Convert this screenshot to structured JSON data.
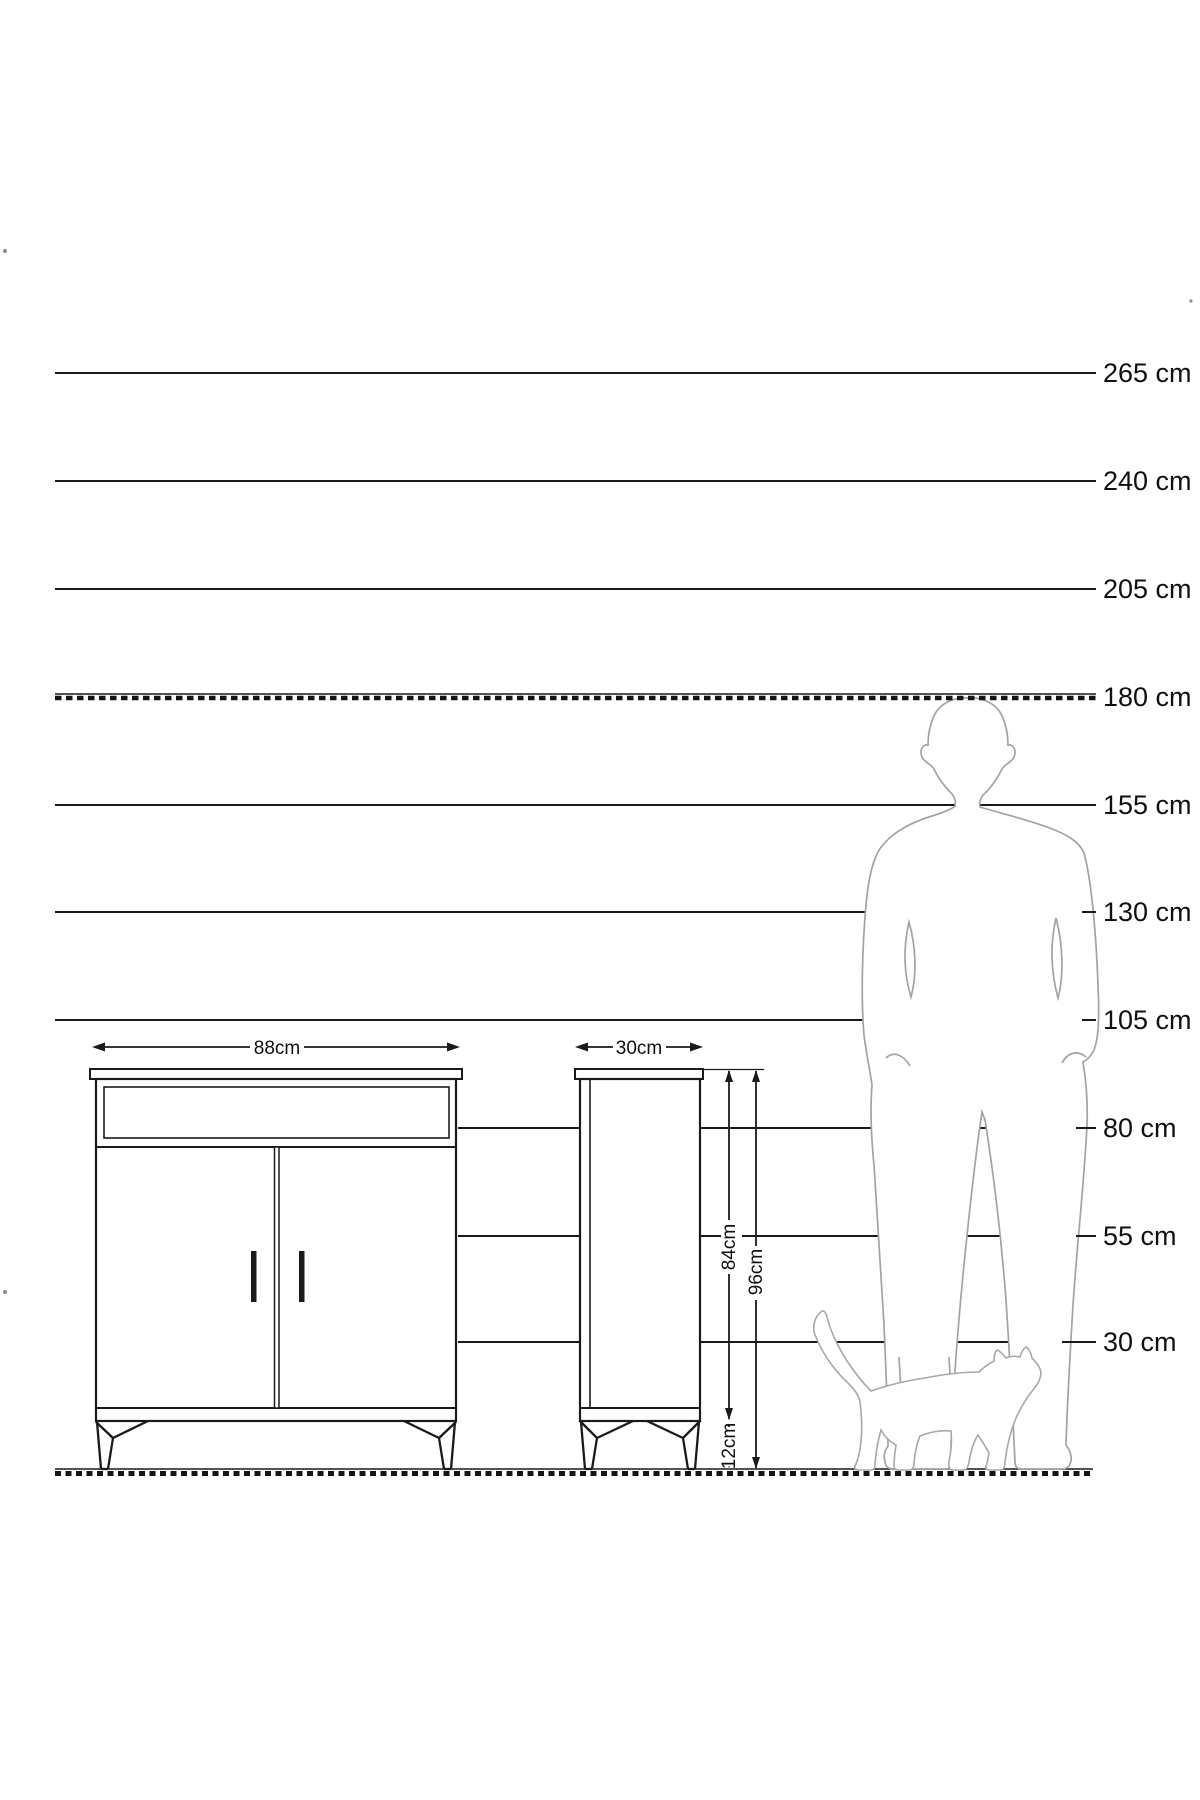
{
  "ruler": {
    "unit": "cm",
    "labels": [
      "265 cm",
      "240 cm",
      "205 cm",
      "180 cm",
      "155 cm",
      "130 cm",
      "105 cm",
      "80 cm",
      "55 cm",
      "30 cm"
    ]
  },
  "front_view": {
    "width_label": "88cm"
  },
  "side_view": {
    "width_label": "30cm",
    "body_height_label": "84cm",
    "total_height_label": "96cm",
    "leg_height_label": "12cm"
  },
  "figures": {
    "man": "man-silhouette",
    "cat": "cat-silhouette"
  },
  "colors": {
    "background": "#ffffff",
    "line": "#1a1a1a",
    "figure_outline": "#a3a3a3",
    "text": "#101010"
  }
}
